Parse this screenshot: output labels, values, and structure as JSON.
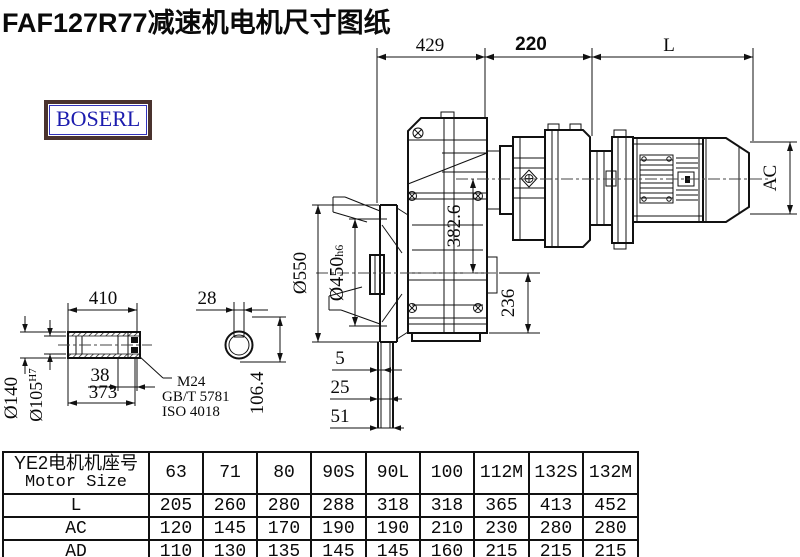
{
  "title": "FAF127R77减速机电机尺寸图纸",
  "logo": {
    "text": "BOSERL"
  },
  "drawing": {
    "top": {
      "d429": "429",
      "d220": "220",
      "dL": "L"
    },
    "main": {
      "d3826": "382.6",
      "d236": "236",
      "d550": "Ø550",
      "d450": "Ø450",
      "d450tol": "h6",
      "dac": "AC",
      "d5": "5",
      "d25": "25",
      "d51": "51"
    },
    "shaft": {
      "d410": "410",
      "d140": "Ø140",
      "d105": "Ø105",
      "d105tol": "H7",
      "d38": "38",
      "d373": "373",
      "thread": "M24",
      "std1": "GB/T 5781",
      "std2": "ISO 4018",
      "d28": "28",
      "d1064": "106.4"
    }
  },
  "table": {
    "header_cn": "YE2电机机座号",
    "header_en": "Motor Size",
    "columns": [
      "63",
      "71",
      "80",
      "90S",
      "90L",
      "100",
      "112M",
      "132S",
      "132M"
    ],
    "rows": [
      {
        "label": "L",
        "values": [
          "205",
          "260",
          "280",
          "288",
          "318",
          "318",
          "365",
          "413",
          "452"
        ]
      },
      {
        "label": "AC",
        "values": [
          "120",
          "145",
          "170",
          "190",
          "190",
          "210",
          "230",
          "280",
          "280"
        ]
      },
      {
        "label": "AD",
        "values": [
          "110",
          "130",
          "135",
          "145",
          "145",
          "160",
          "215",
          "215",
          "215"
        ]
      }
    ]
  }
}
